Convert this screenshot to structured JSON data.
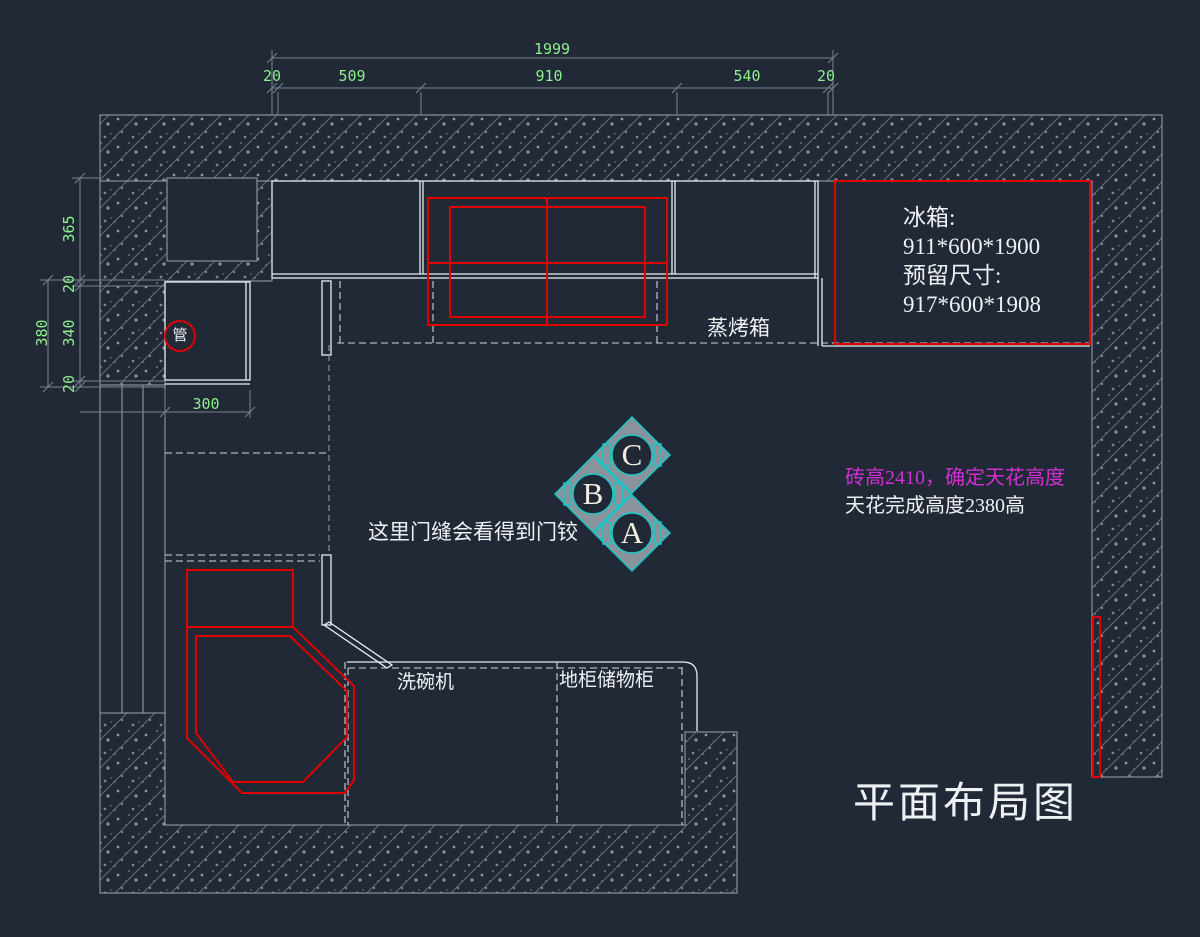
{
  "plan": {
    "title": "平面布局图",
    "colors": {
      "background": "#212936",
      "line_white": "#e9ecef",
      "annotation_red": "#e00000",
      "dimension_green": "#8ef08e",
      "note_magenta": "#d12fd1",
      "marker_cyan": "#19c7c7"
    },
    "dimensions": {
      "top_total": "1999",
      "top_segments": [
        "20",
        "509",
        "910",
        "540",
        "20"
      ],
      "left_segments": [
        "365",
        "20",
        "340",
        "20"
      ],
      "left_outer": "380",
      "pipe_box_width": "300"
    },
    "notes": {
      "fridge_line1": "冰箱:",
      "fridge_line2": "911*600*1900",
      "fridge_line3": "预留尺寸:",
      "fridge_line4": "917*600*1908",
      "tile_height": "砖高2410，确定天花高度",
      "ceiling_height": "天花完成高度2380高",
      "door_hinge": "这里门缝会看得到门铰"
    },
    "labels": {
      "steam_oven": "蒸烤箱",
      "pipe": "管",
      "dishwasher": "洗碗机",
      "base_storage_cabinet": "地柜储物柜"
    },
    "markers": {
      "a": "A",
      "b": "B",
      "c": "C"
    }
  }
}
